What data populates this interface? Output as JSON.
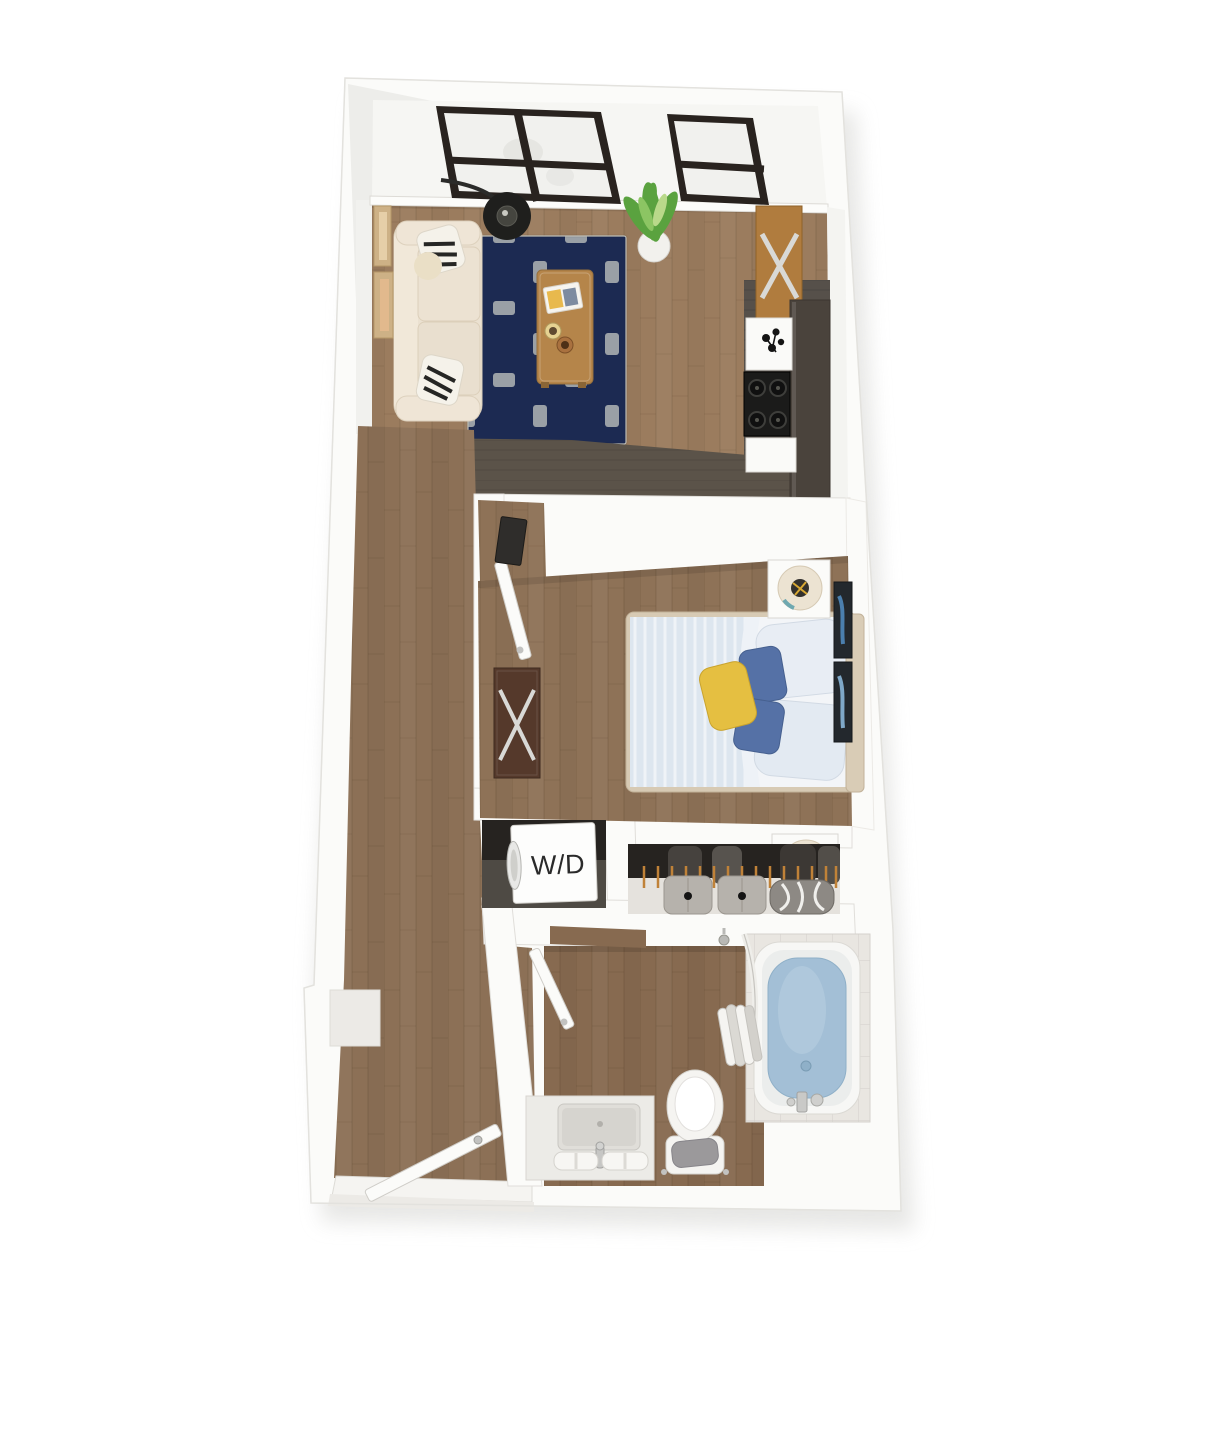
{
  "floorplan": {
    "view": "3d-top-down-apartment-floor-plan",
    "washer_dryer": {
      "label": "W/D"
    },
    "colors": {
      "background": "#ffffff",
      "wall_white": "#fbfbf9",
      "wall_edge": "#d8d6d1",
      "wall_shade": "#ededea",
      "living_floor": "#9b7c5e",
      "hall_floor": "#8c7056",
      "bedroom_floor": "#8e7257",
      "bath_floor": "#876a50",
      "kitchen_floor": "#56504a",
      "threshold_dark": "#5b5349",
      "rug_navy": "#1c2a52",
      "rug_white": "#f2f1ec",
      "rug_gray": "#9aa0a6",
      "sofa_cream": "#ebe1d1",
      "pillow_stripe_black": "#262624",
      "coffee_table_wood": "#b5854a",
      "kitchen_console_wood": "#b07c3e",
      "counter_dark": "#4a433c",
      "stove_black": "#1b1b1a",
      "appliance_white": "#fafaf8",
      "plant_green": "#5aa23f",
      "lamp_black": "#1f1f1d",
      "bed_duvet": "#dde6ef",
      "bed_sheet": "#f3f5f8",
      "pillow_blue": "#5571a6",
      "pillow_yellow": "#e5bf41",
      "headboard_tan": "#d9ccb6",
      "nightstand_white": "#fbfbf9",
      "lamp_shade_cream": "#ece3d2",
      "dresser_walnut": "#55392b",
      "chrome": "#d9d9d6",
      "art_panel_dark": "#23282d",
      "closet_interior_dark": "#262320",
      "hanger_orange": "#c08238",
      "bin_gray": "#b6b2ac",
      "duffel_gray": "#8d8984",
      "wd_unit_white": "#fdfdfc",
      "wd_text": "#2a2a2a",
      "tile_gray": "#e9e6e1",
      "tub_white": "#f7f7f5",
      "tub_water": "#a3bfd6",
      "porcelain_white": "#f5f4f1",
      "towel_gray": "#9b999b",
      "door_white": "#fbfbf9",
      "art_frame_tan": "#cdb186"
    },
    "rooms": [
      {
        "name": "living-room",
        "furniture": [
          "sofa",
          "area-rug",
          "coffee-table",
          "floor-lamp",
          "potted-plant",
          "windows",
          "wall-art"
        ]
      },
      {
        "name": "kitchen",
        "furniture": [
          "console-table",
          "counter",
          "stove",
          "cabinets"
        ]
      },
      {
        "name": "hallway",
        "furniture": [
          "entry-door",
          "wall-niche"
        ]
      },
      {
        "name": "bedroom",
        "furniture": [
          "bed",
          "nightstands",
          "table-lamps",
          "dresser",
          "wall-art-panels",
          "door"
        ]
      },
      {
        "name": "laundry-closet",
        "furniture": [
          "washer-dryer-unit"
        ]
      },
      {
        "name": "closet",
        "furniture": [
          "hangers",
          "storage-bins",
          "duffel-bag"
        ]
      },
      {
        "name": "bathroom",
        "furniture": [
          "vanity-sink",
          "toilet",
          "bathtub",
          "shower-curtain",
          "door"
        ]
      }
    ]
  }
}
